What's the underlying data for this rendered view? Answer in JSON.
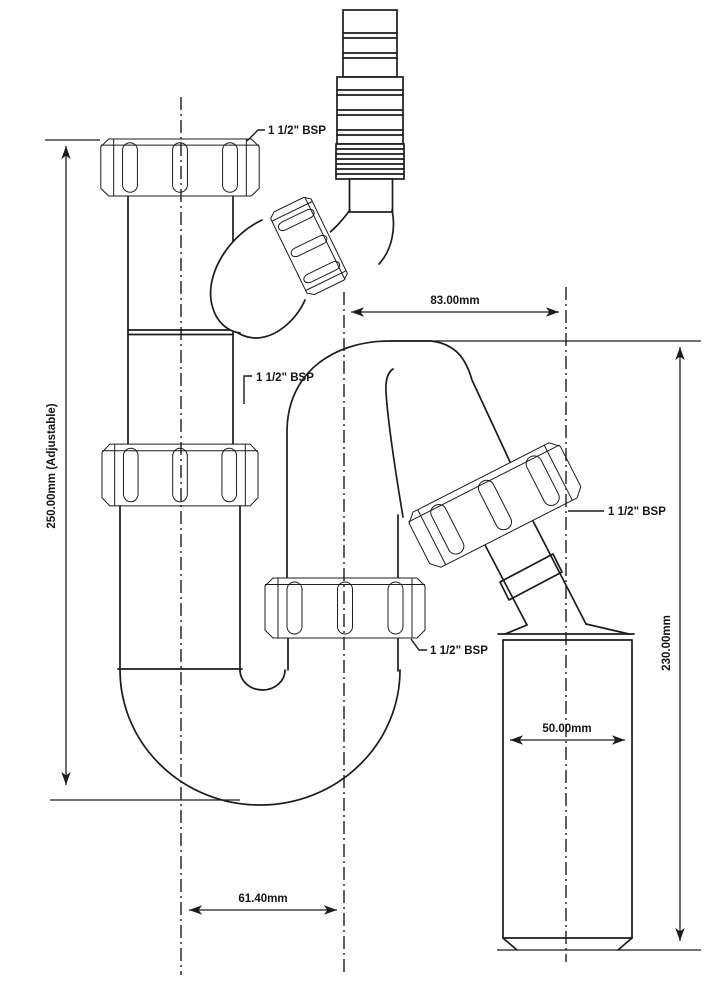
{
  "colors": {
    "line": "#1c1c1c",
    "background": "#ffffff"
  },
  "labels": {
    "bsp_inlet_top": "1 1/2\" BSP",
    "bsp_inlet_mid": "1 1/2\" BSP",
    "bsp_outlet": "1 1/2\" BSP",
    "bsp_trap": "1 1/2\" BSP"
  },
  "dimensions": {
    "inlet_height": "250.00mm (Adjustable)",
    "top_span": "83.00mm",
    "outlet_height": "230.00mm",
    "outlet_width": "50.00mm",
    "bottom_span": "61.40mm"
  }
}
